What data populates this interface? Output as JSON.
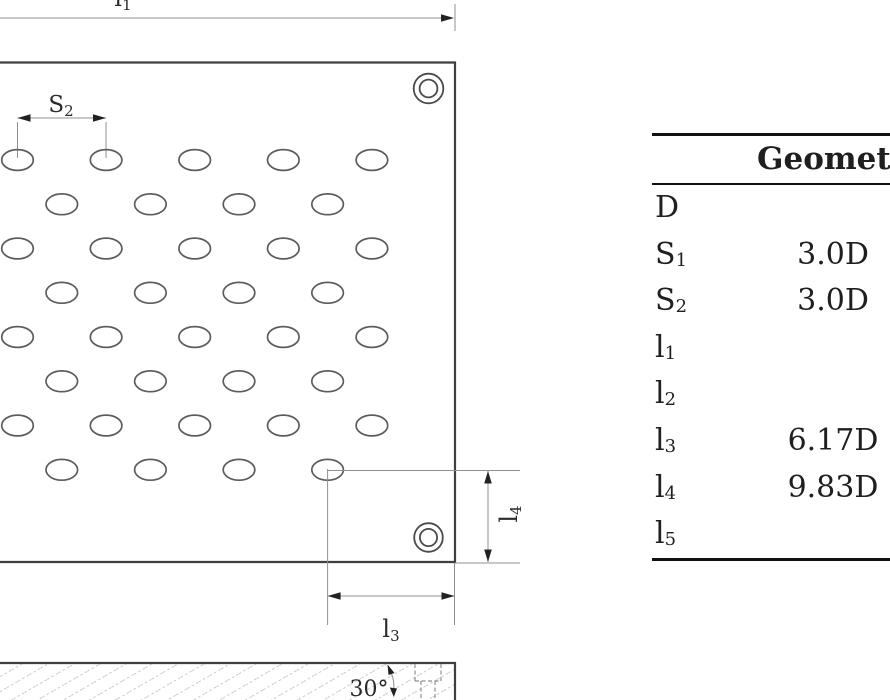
{
  "figure": {
    "labels": {
      "l1": {
        "base": "l",
        "sub": "1"
      },
      "s2": {
        "base": "S",
        "sub": "2"
      },
      "l3": {
        "base": "l",
        "sub": "3"
      },
      "l4": {
        "base": "l",
        "sub": "4"
      },
      "angle": "30°"
    },
    "hole_pattern": {
      "rows": 8,
      "holes_per_odd_row": 5,
      "holes_per_even_row": 4
    }
  },
  "table": {
    "header": "Geometry",
    "rows": [
      {
        "param": {
          "base": "D",
          "sub": ""
        },
        "value": ""
      },
      {
        "param": {
          "base": "S",
          "sub": "1"
        },
        "value": "3.0D"
      },
      {
        "param": {
          "base": "S",
          "sub": "2"
        },
        "value": "3.0D"
      },
      {
        "param": {
          "base": "l",
          "sub": "1"
        },
        "value": ""
      },
      {
        "param": {
          "base": "l",
          "sub": "2"
        },
        "value": ""
      },
      {
        "param": {
          "base": "l",
          "sub": "3"
        },
        "value": "6.17D"
      },
      {
        "param": {
          "base": "l",
          "sub": "4"
        },
        "value": "9.83D"
      },
      {
        "param": {
          "base": "l",
          "sub": "5"
        },
        "value": ""
      }
    ]
  },
  "colors": {
    "ink": "#3f3f3f",
    "dim_lines": "#909090",
    "hatch": "#c9c9c9"
  }
}
